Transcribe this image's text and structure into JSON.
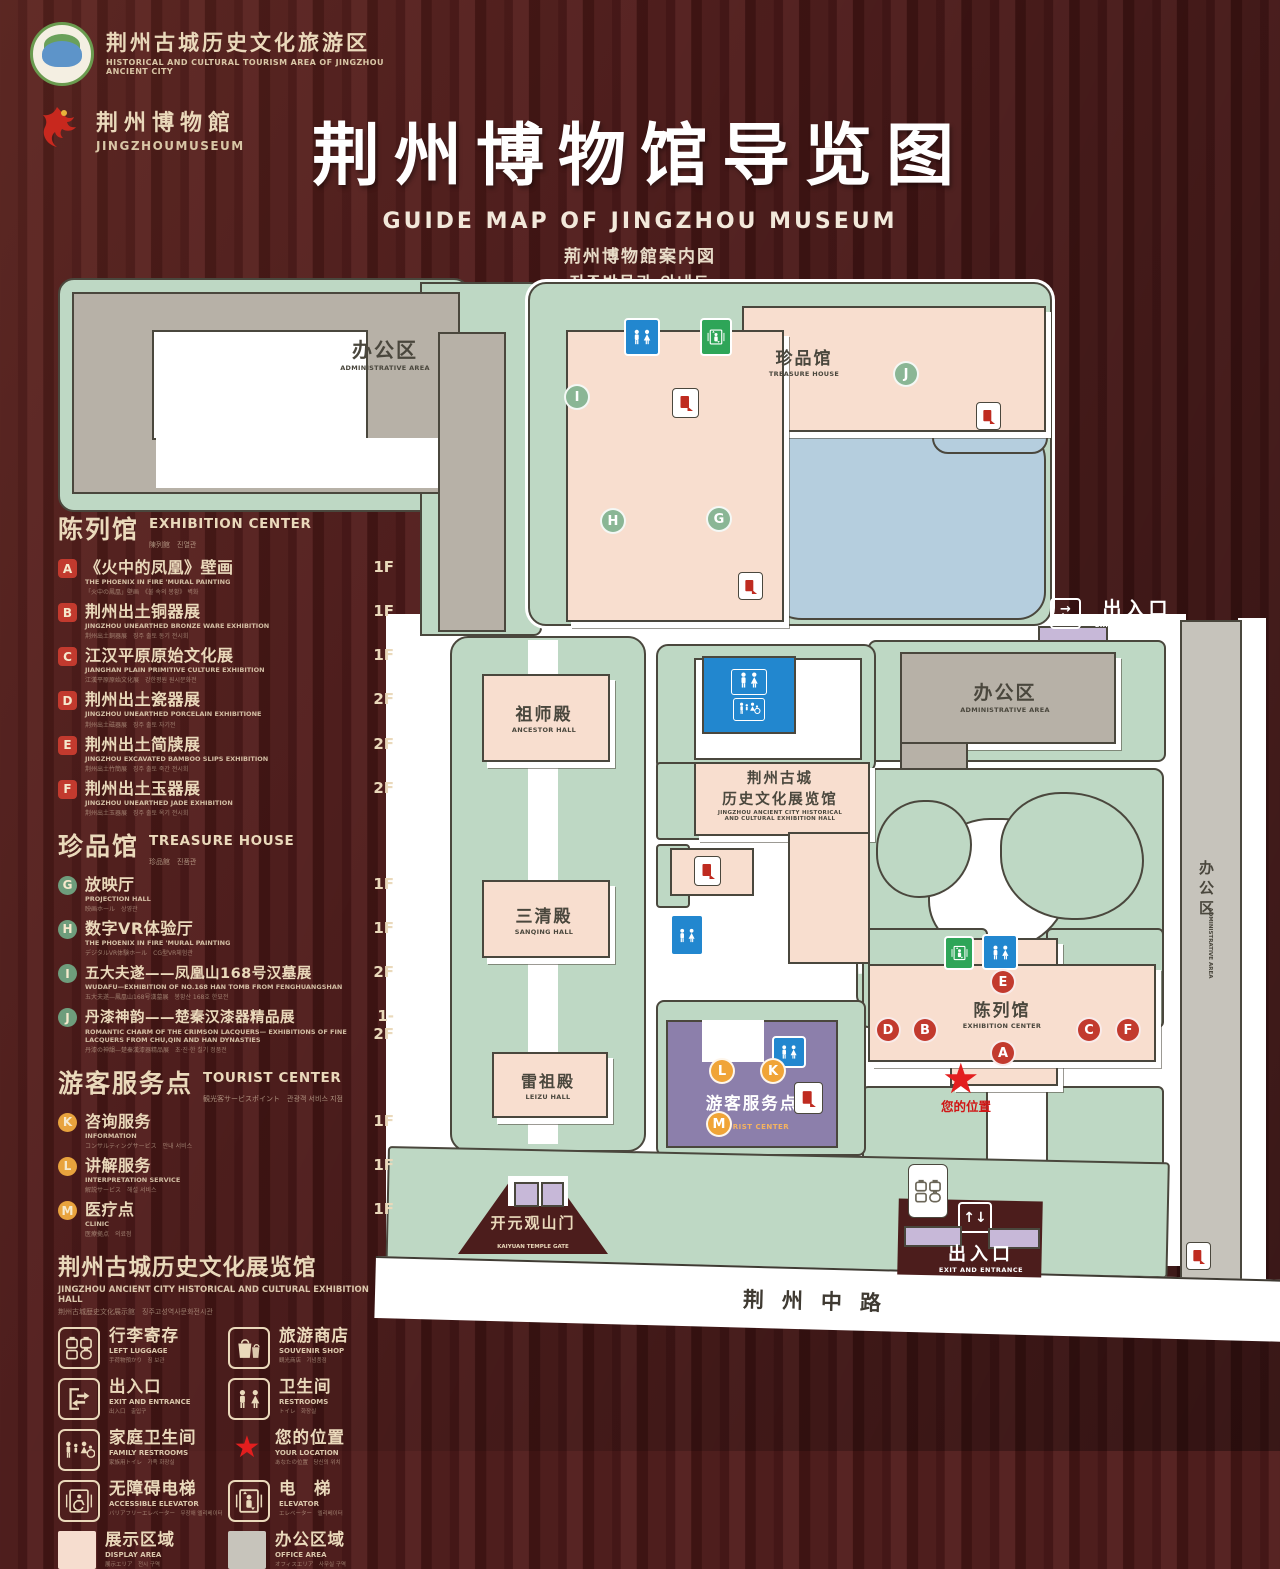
{
  "header": {
    "org_logo": {
      "zh": "荆州古城历史文化旅游区",
      "en": "HISTORICAL AND CULTURAL TOURISM AREA OF JINGZHOU ANCIENT CITY"
    },
    "museum_logo": {
      "zh": "荆州博物館",
      "en": "JINGZHOUMUSEUM"
    },
    "title": "荆州博物馆导览图",
    "subtitle_en": "GUIDE MAP OF JINGZHOU MUSEUM",
    "subtitle_ja": "荊州博物館案内図",
    "subtitle_ko": "징주박물관 안내도"
  },
  "legend": {
    "sections": [
      {
        "title": "陈列馆",
        "en": "EXHIBITION CENTER",
        "sub": "陳列館　진열관",
        "items": [
          {
            "letter": "A",
            "title": "《火中的凤凰》壁画",
            "en": "THE PHOENIX IN FIRE 'MURAL PAINTING",
            "sub": "「火中の鳳凰」壁画　《불 속의 봉황》 벽화",
            "floor": "1F"
          },
          {
            "letter": "B",
            "title": "荆州出土铜器展",
            "en": "JINGZHOU UNEARTHED BRONZE WARE EXHIBITION",
            "sub": "荆州出土銅器展　징주 출토 동기 전시회",
            "floor": "1F"
          },
          {
            "letter": "C",
            "title": "江汉平原原始文化展",
            "en": "JIANGHAN PLAIN PRIMITIVE CULTURE EXHIBITION",
            "sub": "江漢平原原始文化展　강한평원 원시문화전",
            "floor": "1F"
          },
          {
            "letter": "D",
            "title": "荆州出土瓷器展",
            "en": "JINGZHOU UNEARTHED PORCELAIN EXHIBITIONE",
            "sub": "荆州出土磁器展　징주 출토 자기전",
            "floor": "2F"
          },
          {
            "letter": "E",
            "title": "荆州出土简牍展",
            "en": "JINGZHOU EXCAVATED BAMBOO SLIPS EXHIBITION",
            "sub": "荆州出土竹簡展　징주 출토 죽간 전시회",
            "floor": "2F"
          },
          {
            "letter": "F",
            "title": "荆州出土玉器展",
            "en": "JINGZHOU UNEARTHED JADE EXHIBITION",
            "sub": "荆州出土玉器展　징주 출토 옥기 전시회",
            "floor": "2F"
          }
        ]
      },
      {
        "title": "珍品馆",
        "en": "TREASURE HOUSE",
        "sub": "珍品館　진품관",
        "items": [
          {
            "letter": "G",
            "title": "放映厅",
            "en": "PROJECTION HALL",
            "sub": "映画ホール　상영관",
            "floor": "1F"
          },
          {
            "letter": "H",
            "title": "数字VR体验厅",
            "en": "THE PHOENIX IN FIRE 'MURAL PAINTING",
            "sub": "デジタルVR体験ホール　CG型VR체험관",
            "floor": "1F"
          },
          {
            "letter": "I",
            "title": "五大夫遂——凤凰山168号汉墓展",
            "en": "WUDAFU—EXHIBITION OF NO.168 HAN TOMB FROM FENGHUANGSHAN",
            "sub": "五大夫遂—鳳凰山168号漢墓展　봉황산 168호 한묘전",
            "floor": "2F"
          },
          {
            "letter": "J",
            "title": "丹漆神韵——楚秦汉漆器精品展",
            "en": "ROMANTIC CHARM OF THE CRIMSON LACQUERS— EXHIBITIONS OF FINE LACQUERS FROM CHU,QIN AND HAN DYNASTIES",
            "sub": "丹漆の神韻—楚秦漢漆器精品展　초·진·한 칠기 정품전",
            "floor": "1-2F"
          }
        ]
      },
      {
        "title": "游客服务点",
        "en": "TOURIST CENTER",
        "sub": "観光客サービスポイント　관광객 서비스 지점",
        "items": [
          {
            "letter": "K",
            "title": "咨询服务",
            "en": "INFORMATION",
            "sub": "コンサルティングサービス　안내 서비스",
            "floor": "1F"
          },
          {
            "letter": "L",
            "title": "讲解服务",
            "en": "INTERPRETATION SERVICE",
            "sub": "解説サービス　해설 서비스",
            "floor": "1F"
          },
          {
            "letter": "M",
            "title": "医疗点",
            "en": "CLINIC",
            "sub": "医療拠点　의료점",
            "floor": "1F"
          }
        ]
      }
    ],
    "hall_note": {
      "title": "荆州古城历史文化展览馆",
      "en": "JINGZHOU ANCIENT CITY HISTORICAL AND CULTURAL EXHIBITION HALL",
      "sub": "荆州古城歴史文化展示館　징주고성역사문화전시관"
    },
    "facilities": [
      {
        "title": "行李寄存",
        "en": "LEFT LUGGAGE",
        "sub": "手荷物預かり　짐 보관"
      },
      {
        "title": "旅游商店",
        "en": "SOUVENIR SHOP",
        "sub": "観光商店　기념품점"
      },
      {
        "title": "出入口",
        "en": "EXIT AND ENTRANCE",
        "sub": "出入口　출입구"
      },
      {
        "title": "卫生间",
        "en": "RESTROOMS",
        "sub": "トイレ　화장실"
      },
      {
        "title": "家庭卫生间",
        "en": "FAMILY RESTROOMS",
        "sub": "家族用トイレ　가족 화장실"
      },
      {
        "title": "您的位置",
        "en": "YOUR LOCATION",
        "sub": "あなたの位置　당신의 위치"
      },
      {
        "title": "无障碍电梯",
        "en": "ACCESSIBLE ELEVATOR",
        "sub": "バリアフリーエレベーター　무장애 엘리베이터"
      },
      {
        "title": "电　梯",
        "en": "ELEVATOR",
        "sub": "エレベーター　엘리베이터"
      }
    ],
    "areas": [
      {
        "title": "展示区域",
        "en": "DISPLAY AREA",
        "sub": "展示エリア　전시 구역",
        "color": "#f6ddcf"
      },
      {
        "title": "办公区域",
        "en": "OFFICE AREA",
        "sub": "オフィスエリア　사무실 구역",
        "color": "#c7c4bb"
      }
    ]
  },
  "map": {
    "labels": {
      "admin_top": {
        "zh": "办公区",
        "en": "ADMINISTRATIVE AREA"
      },
      "treasure": {
        "zh": "珍品馆",
        "en": "TREASURE HOUSE"
      },
      "ancestor": {
        "zh": "祖师殿",
        "en": "ANCESTOR HALL"
      },
      "sanqing": {
        "zh": "三清殿",
        "en": "SANQING HALL"
      },
      "leizu": {
        "zh": "雷祖殿",
        "en": "LEIZU HALL"
      },
      "exhibition_hall": {
        "zh1": "荆州古城",
        "zh2": "历史文化展览馆",
        "en1": "JINGZHOU ANCIENT CITY HISTORICAL",
        "en2": "AND CULTURAL EXHIBITION HALL"
      },
      "admin_right": {
        "zh": "办公区",
        "en": "ADMINISTRATIVE AREA"
      },
      "admin_strip": {
        "zh": "办公区",
        "en": "ADMINISTRATIVE AREA"
      },
      "exhibition_center": {
        "zh": "陈列馆",
        "en": "EXHIBITION CENTER"
      },
      "tourist_center": {
        "zh": "游客服务点",
        "en": "TOURIST CENTER"
      },
      "gate": {
        "zh": "开元观山门",
        "en": "KAIYUAN TEMPLE GATE"
      },
      "exit_top": {
        "zh": "出入口",
        "en": "EXIT AND ENTRANCE"
      },
      "exit_bottom": {
        "zh": "出入口",
        "en": "EXIT AND ENTRANCE"
      },
      "road": "荆州中路",
      "your_location": "您的位置"
    },
    "markers": {
      "a": "A",
      "b": "B",
      "c": "C",
      "d": "D",
      "e": "E",
      "f": "F",
      "g": "G",
      "h": "H",
      "i": "I",
      "j": "J",
      "k": "K",
      "l": "L",
      "m": "M"
    }
  }
}
